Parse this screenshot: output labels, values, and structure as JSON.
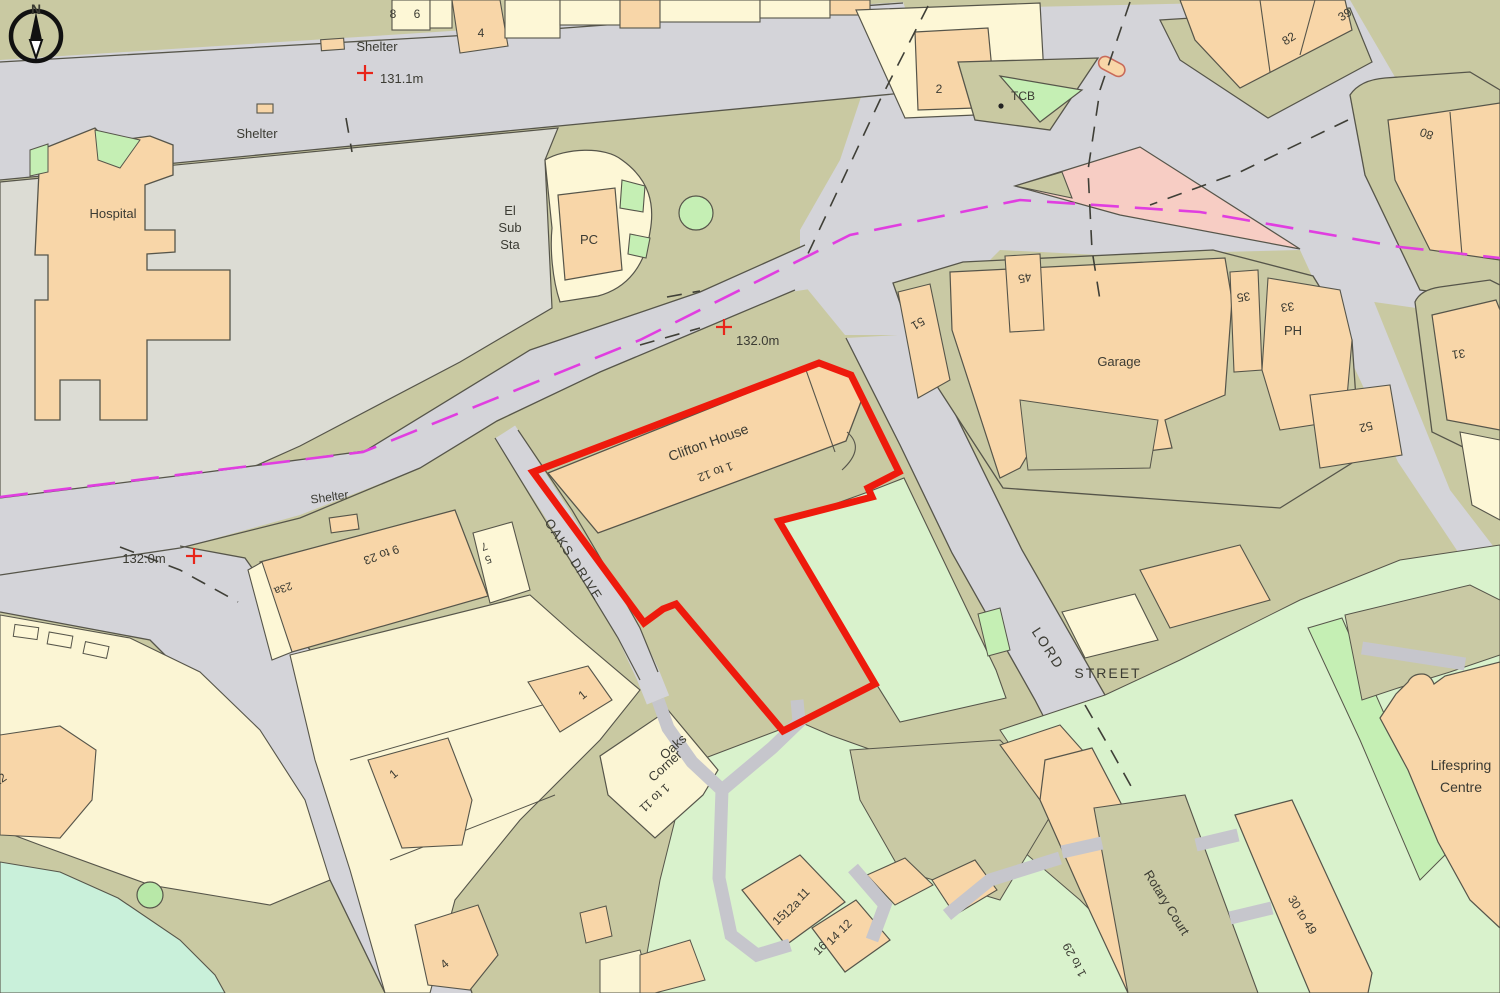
{
  "map": {
    "title": "OS site location plan",
    "compass": {
      "north_label": "N"
    },
    "site_outline": {
      "name": "Clifton House site boundary",
      "color": "#ee1a0c"
    },
    "colors": {
      "road": "#d4d4d9",
      "verge_olive": "#c9c9a2",
      "grounds_grey_green": "#dcdcd4",
      "building_orange": "#f8d6a8",
      "building_cream": "#fdf7d6",
      "garden_green": "#d9f2cc",
      "bright_green": "#c5efb4",
      "mint_green": "#c9f0da",
      "island_pink": "#f7cdc4",
      "boundary_magenta": "#e03ee0",
      "outline_dark": "#56554a",
      "text": "#3b3b33",
      "red": "#ee1a0c"
    },
    "spot_heights": [
      {
        "label": "131.1m",
        "x": 365,
        "y": 73
      },
      {
        "label": "132.0m",
        "x": 724,
        "y": 327
      },
      {
        "label": "132.0m",
        "x": 194,
        "y": 556
      }
    ],
    "labels": [
      {
        "id": "shelter-1",
        "text": "Shelter",
        "x": 377,
        "y": 51,
        "rot": 0,
        "size": 13,
        "anchor": "middle"
      },
      {
        "id": "height-131-1",
        "text": "131.1m",
        "x": 380,
        "y": 83,
        "rot": 0,
        "size": 13,
        "anchor": "start"
      },
      {
        "id": "shelter-2",
        "text": "Shelter",
        "x": 257,
        "y": 138,
        "rot": 0,
        "size": 13,
        "anchor": "middle"
      },
      {
        "id": "hospital",
        "text": "Hospital",
        "x": 113,
        "y": 218,
        "rot": 0,
        "size": 13,
        "anchor": "middle"
      },
      {
        "id": "el",
        "text": "El",
        "x": 510,
        "y": 215,
        "rot": 0,
        "size": 13,
        "anchor": "middle"
      },
      {
        "id": "sub",
        "text": "Sub",
        "x": 510,
        "y": 232,
        "rot": 0,
        "size": 13,
        "anchor": "middle"
      },
      {
        "id": "sta",
        "text": "Sta",
        "x": 510,
        "y": 249,
        "rot": 0,
        "size": 13,
        "anchor": "middle"
      },
      {
        "id": "pc",
        "text": "PC",
        "x": 589,
        "y": 244,
        "rot": 0,
        "size": 13,
        "anchor": "middle"
      },
      {
        "id": "num-8",
        "text": "8",
        "x": 393,
        "y": 18,
        "rot": 0,
        "size": 12,
        "anchor": "middle"
      },
      {
        "id": "num-6",
        "text": "6",
        "x": 417,
        "y": 18,
        "rot": 0,
        "size": 12,
        "anchor": "middle"
      },
      {
        "id": "num-4-top",
        "text": "4",
        "x": 481,
        "y": 37,
        "rot": 0,
        "size": 12,
        "anchor": "middle"
      },
      {
        "id": "num-2",
        "text": "2",
        "x": 939,
        "y": 93,
        "rot": 0,
        "size": 12,
        "anchor": "middle"
      },
      {
        "id": "tcb",
        "text": "TCB",
        "x": 1023,
        "y": 100,
        "rot": 0,
        "size": 12,
        "anchor": "middle"
      },
      {
        "id": "num-82",
        "text": "82",
        "x": 1291,
        "y": 42,
        "rot": -33,
        "size": 12,
        "anchor": "middle"
      },
      {
        "id": "num-39",
        "text": "39",
        "x": 1347,
        "y": 18,
        "rot": -33,
        "size": 12,
        "anchor": "middle"
      },
      {
        "id": "num-80",
        "text": "80",
        "x": 1428,
        "y": 130,
        "rot": 200,
        "size": 12,
        "anchor": "middle"
      },
      {
        "id": "num-45",
        "text": "45",
        "x": 1024,
        "y": 274,
        "rot": 168,
        "size": 12,
        "anchor": "middle"
      },
      {
        "id": "num-51",
        "text": "51",
        "x": 916,
        "y": 320,
        "rot": 150,
        "size": 12,
        "anchor": "middle"
      },
      {
        "id": "num-35",
        "text": "35",
        "x": 1243,
        "y": 293,
        "rot": 172,
        "size": 12,
        "anchor": "middle"
      },
      {
        "id": "num-33",
        "text": "33",
        "x": 1287,
        "y": 303,
        "rot": 172,
        "size": 12,
        "anchor": "middle"
      },
      {
        "id": "ph",
        "text": "PH",
        "x": 1293,
        "y": 335,
        "rot": 0,
        "size": 13,
        "anchor": "middle"
      },
      {
        "id": "garage",
        "text": "Garage",
        "x": 1119,
        "y": 366,
        "rot": 0,
        "size": 13,
        "anchor": "middle"
      },
      {
        "id": "num-52",
        "text": "52",
        "x": 1365,
        "y": 423,
        "rot": 165,
        "size": 12,
        "anchor": "middle"
      },
      {
        "id": "num-31",
        "text": "31",
        "x": 1458,
        "y": 350,
        "rot": 172,
        "size": 12,
        "anchor": "middle"
      },
      {
        "id": "height-132-top",
        "text": "132.0m",
        "x": 736,
        "y": 345,
        "rot": 0,
        "size": 13,
        "anchor": "start"
      },
      {
        "id": "clifton-house",
        "text": "Clifton House",
        "x": 710,
        "y": 447,
        "rot": -20,
        "size": 14,
        "anchor": "middle"
      },
      {
        "id": "one-to-12",
        "text": "1 to 12",
        "x": 714,
        "y": 468,
        "rot": 160,
        "size": 12,
        "anchor": "middle"
      },
      {
        "id": "shelter-3",
        "text": "Shelter",
        "x": 330,
        "y": 501,
        "rot": -8,
        "size": 12,
        "anchor": "middle"
      },
      {
        "id": "height-132-left",
        "text": "132.0m",
        "x": 144,
        "y": 563,
        "rot": 0,
        "size": 13,
        "anchor": "middle"
      },
      {
        "id": "nine-to-23",
        "text": "9 to 23",
        "x": 380,
        "y": 551,
        "rot": 160,
        "size": 12,
        "anchor": "middle"
      },
      {
        "id": "num-23a",
        "text": "23a",
        "x": 282,
        "y": 585,
        "rot": 160,
        "size": 11,
        "anchor": "middle"
      },
      {
        "id": "num-7",
        "text": "7",
        "x": 483,
        "y": 543,
        "rot": 160,
        "size": 11,
        "anchor": "middle"
      },
      {
        "id": "num-5",
        "text": "5",
        "x": 487,
        "y": 556,
        "rot": 160,
        "size": 11,
        "anchor": "middle"
      },
      {
        "id": "oaks-drive",
        "text": "OAKS DRIVE",
        "x": 570,
        "y": 562,
        "rot": 57,
        "size": 13,
        "anchor": "middle",
        "ls": 1.5
      },
      {
        "id": "lord",
        "text": "LORD",
        "x": 1044,
        "y": 651,
        "rot": 57,
        "size": 14,
        "anchor": "middle",
        "ls": 2
      },
      {
        "id": "street",
        "text": "STREET",
        "x": 1108,
        "y": 678,
        "rot": 0,
        "size": 14,
        "anchor": "middle",
        "ls": 2
      },
      {
        "id": "num-1-upper",
        "text": "1",
        "x": 585,
        "y": 698,
        "rot": -40,
        "size": 12,
        "anchor": "middle"
      },
      {
        "id": "num-1-lower",
        "text": "1",
        "x": 396,
        "y": 777,
        "rot": -40,
        "size": 12,
        "anchor": "middle"
      },
      {
        "id": "num-4-bottom",
        "text": "4",
        "x": 447,
        "y": 967,
        "rot": -40,
        "size": 12,
        "anchor": "middle"
      },
      {
        "id": "num-22",
        "text": "22",
        "x": 2,
        "y": 783,
        "rot": -35,
        "size": 12,
        "anchor": "middle"
      },
      {
        "id": "oaks",
        "text": "Oaks",
        "x": 676,
        "y": 750,
        "rot": -42,
        "size": 13,
        "anchor": "middle"
      },
      {
        "id": "corner",
        "text": "Corner",
        "x": 668,
        "y": 769,
        "rot": -42,
        "size": 13,
        "anchor": "middle"
      },
      {
        "id": "one-to-11",
        "text": "1 to 11",
        "x": 652,
        "y": 795,
        "rot": 138,
        "size": 12,
        "anchor": "middle"
      },
      {
        "id": "num-11",
        "text": "11",
        "x": 806,
        "y": 897,
        "rot": -45,
        "size": 12,
        "anchor": "middle"
      },
      {
        "id": "num-12a",
        "text": "12a",
        "x": 794,
        "y": 911,
        "rot": -45,
        "size": 12,
        "anchor": "middle"
      },
      {
        "id": "num-15",
        "text": "15",
        "x": 782,
        "y": 921,
        "rot": -45,
        "size": 12,
        "anchor": "middle"
      },
      {
        "id": "num-12",
        "text": "12",
        "x": 848,
        "y": 929,
        "rot": -45,
        "size": 12,
        "anchor": "middle"
      },
      {
        "id": "num-14",
        "text": "14",
        "x": 836,
        "y": 941,
        "rot": -45,
        "size": 12,
        "anchor": "middle"
      },
      {
        "id": "num-16",
        "text": "16",
        "x": 823,
        "y": 951,
        "rot": -45,
        "size": 12,
        "anchor": "middle"
      },
      {
        "id": "one-to-29",
        "text": "1 to 29",
        "x": 1078,
        "y": 958,
        "rot": -118,
        "size": 12,
        "anchor": "middle"
      },
      {
        "id": "rotary-court",
        "text": "Rotary Court",
        "x": 1163,
        "y": 905,
        "rot": 58,
        "size": 13,
        "anchor": "middle"
      },
      {
        "id": "thirty-to-49",
        "text": "30 to 49",
        "x": 1299,
        "y": 917,
        "rot": 58,
        "size": 12,
        "anchor": "middle"
      },
      {
        "id": "lifespring-1",
        "text": "Lifespring",
        "x": 1461,
        "y": 770,
        "rot": 0,
        "size": 14,
        "anchor": "middle"
      },
      {
        "id": "lifespring-2",
        "text": "Centre",
        "x": 1461,
        "y": 792,
        "rot": 0,
        "size": 14,
        "anchor": "middle"
      }
    ]
  }
}
